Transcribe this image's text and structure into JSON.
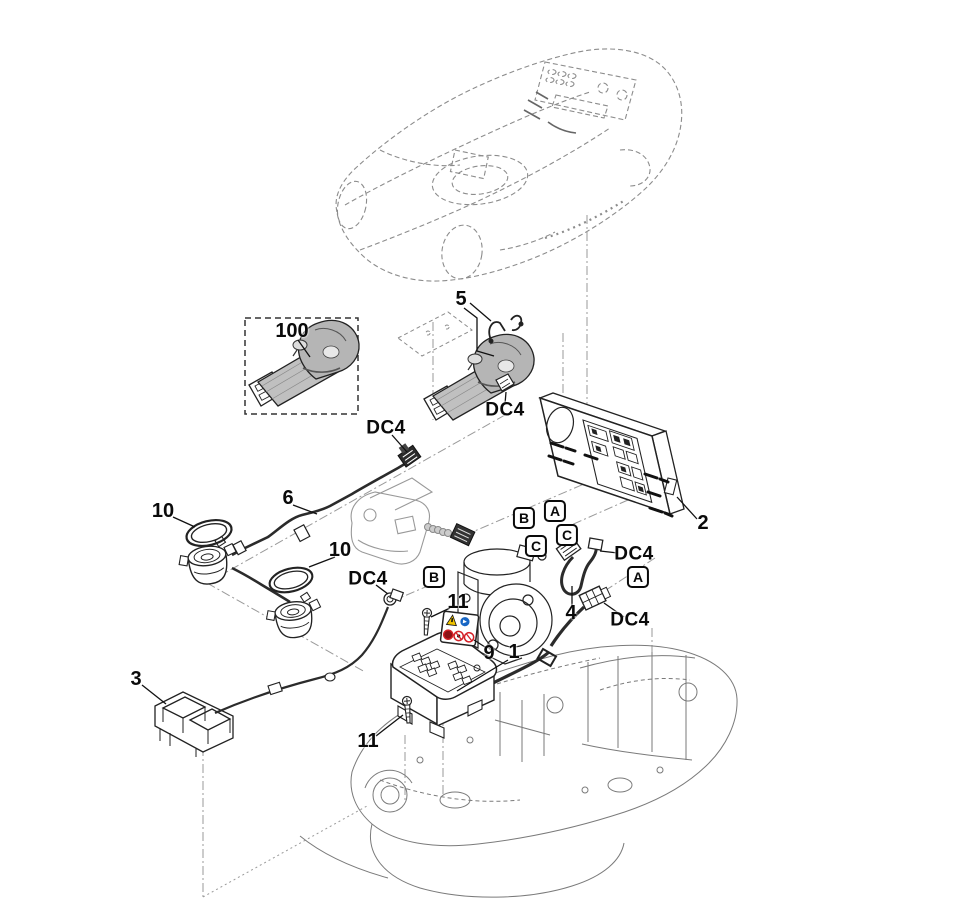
{
  "diagram": {
    "kind": "exploded-parts-drawing",
    "subject": "robotic-mower-electrics",
    "ink_color": "#1a1a1a",
    "ghost_color": "#8c8c8c",
    "guide_line_color": "#9a9a9a"
  },
  "callouts": {
    "part100": "100",
    "part5": "5",
    "part2": "2",
    "part6": "6",
    "part10_left": "10",
    "part10_mid": "10",
    "part3": "3",
    "part11_top": "11",
    "part11_bottom": "11",
    "part9": "9",
    "part1": "1",
    "part4": "4"
  },
  "connector_labels": {
    "dc4_part5": "DC4",
    "dc4_cable6": "DC4",
    "dc4_sensor": "DC4",
    "dc4_cable4_top": "DC4",
    "dc4_cable4_bottom": "DC4"
  },
  "port_markers": {
    "a_top": "A",
    "b_top": "B",
    "c_right": "C",
    "c_left": "C",
    "b_mid": "B",
    "a_right": "A"
  },
  "safety_label": {
    "warning_color": "#f2c500",
    "mandatory_color": "#1766c4",
    "prohibition_color": "#d41f26"
  }
}
